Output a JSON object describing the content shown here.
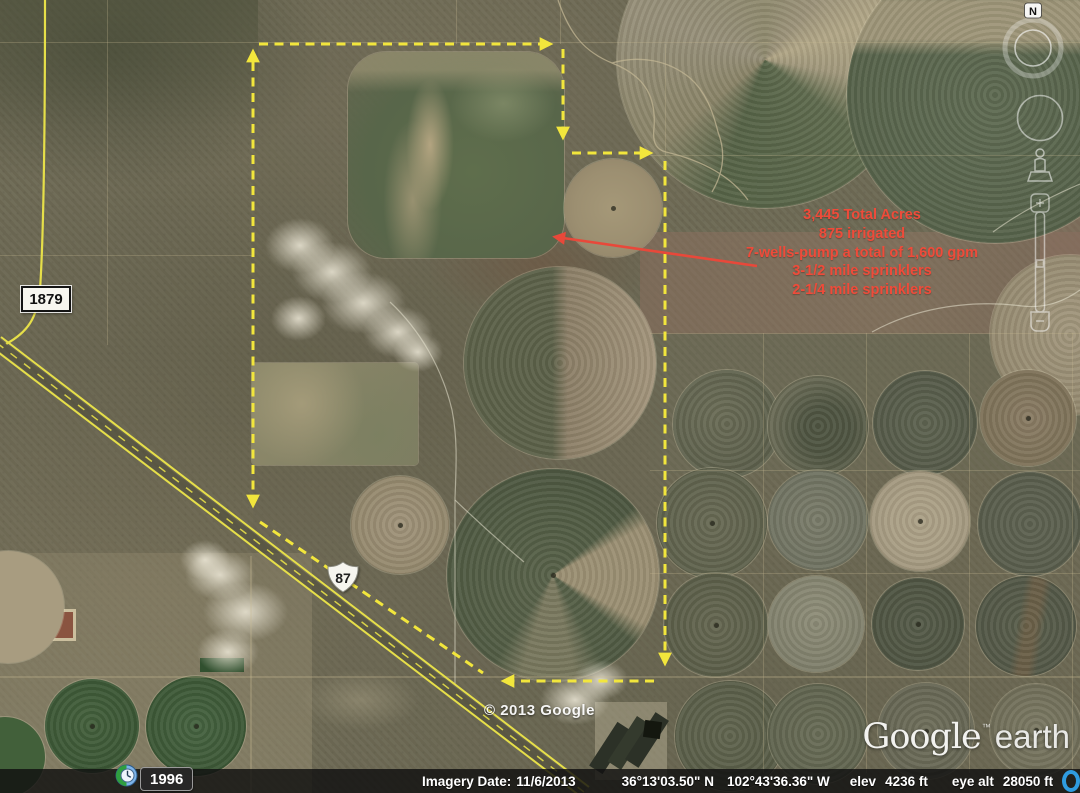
{
  "annotation": {
    "color": "#ef4b3a",
    "lines": [
      "3,445 Total Acres",
      "875 irrigated",
      "7-wells-pump a total of 1,600 gpm",
      "3-1/2 mile sprinklers",
      "2-1/4 mile sprinklers"
    ]
  },
  "road_labels": {
    "fm_road": "1879",
    "us_highway": "87"
  },
  "watermark": "© 2013 Google",
  "logo": {
    "google": "Google",
    "tm": "™",
    "earth": "earth"
  },
  "compass": {
    "north": "N"
  },
  "time_badge": {
    "year": "1996"
  },
  "status_bar": {
    "imagery_date_label": "Imagery Date:",
    "imagery_date": "11/6/2013",
    "latitude": "36°13'03.50\" N",
    "longitude": "102°43'36.36\" W",
    "elev_label": "elev",
    "elev_value": "4236 ft",
    "eye_alt_label": "eye alt",
    "eye_alt_value": "28050 ft"
  },
  "colors": {
    "boundary_yellow": "#f2e63c",
    "road_yellow": "#e6df49",
    "annotation_red": "#ef4b3a",
    "streaming_icon_blue": "#2f9bdf"
  }
}
